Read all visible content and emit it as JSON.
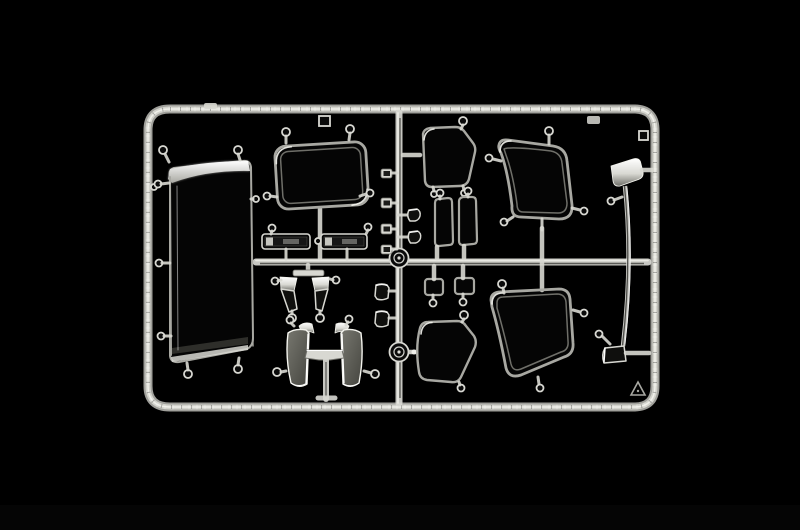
{
  "scene": {
    "subject": "model-kit-clear-parts-sprue",
    "description": "Clear injection-molded sprue of transparent model-kit window and glazing parts photographed on a black background",
    "background": "black studio backdrop",
    "text_visible": "none"
  },
  "palette": {
    "background": "#000000",
    "plastic_bright": "#f4f4ee",
    "plastic_light": "#d8d8d2",
    "plastic_mid": "#a8a8a2",
    "plastic_dim": "#6f6f69",
    "plastic_dark": "#2e2e2a",
    "panel_face_light": "#77776f",
    "panel_face_dark": "#45453f",
    "highlight_white": "#ffffff"
  },
  "parts": [
    {
      "name": "sprue-frame",
      "label": "rounded rectangular sprue frame",
      "count": 1
    },
    {
      "name": "runner-network",
      "label": "cross runners with two round injection hubs",
      "count": 1
    },
    {
      "name": "roof-deflector",
      "label": "large curved clear panel with bright top edge",
      "count": 1
    },
    {
      "name": "windshield",
      "label": "framed windshield pane with double rim",
      "count": 1
    },
    {
      "name": "quarter-window-upper",
      "label": "small trapezoid quarter window",
      "count": 1
    },
    {
      "name": "side-window-upper",
      "label": "large rounded side window",
      "count": 1
    },
    {
      "name": "pillar-trim",
      "label": "long thin pillar strip with angled head and foot",
      "count": 1
    },
    {
      "name": "quarter-window-lower",
      "label": "small trapezoid quarter window",
      "count": 1
    },
    {
      "name": "side-window-lower",
      "label": "large rounded side window",
      "count": 1
    },
    {
      "name": "door-window",
      "label": "narrow door window pane",
      "count": 2
    },
    {
      "name": "vent-window",
      "label": "small square vent pane",
      "count": 2
    },
    {
      "name": "sign-board",
      "label": "thin illuminated name-board strip",
      "count": 2
    },
    {
      "name": "mirror-arm",
      "label": "angled chrome-look mirror arm",
      "count": 2
    },
    {
      "name": "corner-deflector",
      "label": "curved corner deflector panel",
      "count": 2
    },
    {
      "name": "small-clip",
      "label": "small rectangular clip",
      "count": 4
    },
    {
      "name": "handle-lens",
      "label": "small D-shaped lens",
      "count": 2
    },
    {
      "name": "mirror-lens",
      "label": "small rounded lens",
      "count": 2
    },
    {
      "name": "molded-triangle-mark",
      "label": "small molded triangle mark in frame corner",
      "count": 1
    }
  ]
}
